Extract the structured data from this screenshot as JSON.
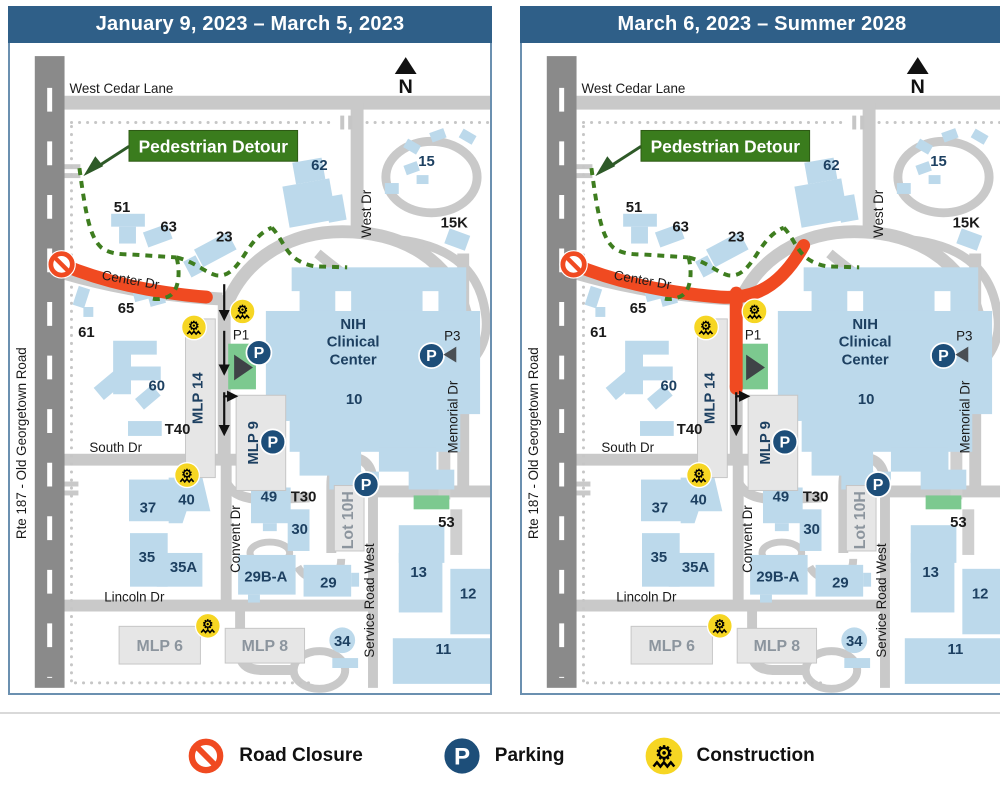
{
  "panels": {
    "left": {
      "title": "January 9, 2023 – March 5, 2023"
    },
    "right": {
      "title": "March 6, 2023 – Summer 2028"
    }
  },
  "map": {
    "north_label": "N",
    "detour_label": "Pedestrian Detour",
    "streets": {
      "west_cedar_lane": "West Cedar Lane",
      "rte_187": "Rte 187 - Old Georgetown Road",
      "center_dr": "Center Dr",
      "west_dr": "West Dr",
      "south_dr": "South Dr",
      "lincoln_dr": "Lincoln Dr",
      "convent_dr": "Convent Dr",
      "memorial_dr": "Memorial Dr",
      "service_road_west": "Service Road West"
    },
    "buildings": {
      "b62": "62",
      "b15": "15",
      "b15k": "15K",
      "b51": "51",
      "b63": "63",
      "b23": "23",
      "b65": "65",
      "b61": "61",
      "b60": "60",
      "t40": "T40",
      "b37": "37",
      "b40": "40",
      "b35": "35",
      "b35a": "35A",
      "b49": "49",
      "t30": "T30",
      "b30": "30",
      "b29ba": "29B-A",
      "b29": "29",
      "b53": "53",
      "b13": "13",
      "b12": "12",
      "b11": "11",
      "b34": "34",
      "b10": "10",
      "nih_line1": "NIH",
      "nih_line2": "Clinical",
      "nih_line3": "Center"
    },
    "parking": {
      "p_letter": "P",
      "p1": "P1",
      "p3": "P3",
      "mlp14": "MLP 14",
      "mlp9": "MLP 9",
      "mlp6": "MLP 6",
      "mlp8": "MLP 8",
      "lot10h": "Lot 10H"
    }
  },
  "legend": {
    "road_closure": "Road Closure",
    "parking": "Parking",
    "construction": "Construction"
  },
  "colors": {
    "header_bg": "#2F5F88",
    "closure_orange": "#F04A21",
    "parking_blue": "#1D4E79",
    "construction_yellow": "#F6D623",
    "detour_green": "#3A7C1D",
    "building_blue": "#BCD9EB",
    "road_gray": "#C9C9C9",
    "highway_gray": "#8A8A8A",
    "entrance_green": "#7CC98F"
  }
}
